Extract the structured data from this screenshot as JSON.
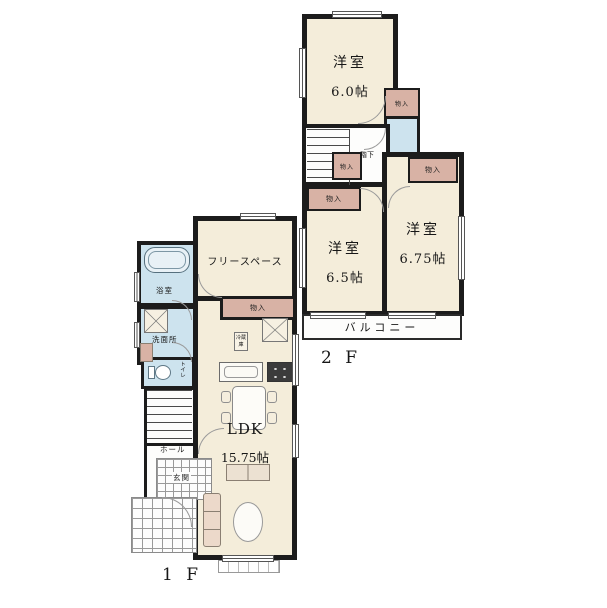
{
  "colors": {
    "wall": "#1c1c1c",
    "room": "#f4edda",
    "closet": "#d8b2a5",
    "wet": "#cde3ee"
  },
  "f2": {
    "floor_label": "2 F",
    "bedroom_top": {
      "name": "洋室",
      "size": "6.0帖"
    },
    "bedroom_left": {
      "name": "洋室",
      "size": "6.5帖"
    },
    "bedroom_right": {
      "name": "洋室",
      "size": "6.75帖"
    },
    "closet_top": "物入",
    "closet_hall": "物入",
    "closet_left": "物入",
    "closet_right": "物入",
    "toilet": "トイレ",
    "stairs_note": "階下",
    "balcony": "バルコニー"
  },
  "f1": {
    "floor_label": "1 F",
    "free_space": "フリースペース",
    "bath": "浴室",
    "washroom": "洗面所",
    "toilet": "トイレ",
    "hall": "ホール",
    "entrance": "玄関",
    "closet": "物入",
    "ldk_name": "LDK",
    "ldk_size": "15.75帖",
    "fridge": "冷蔵庫"
  }
}
